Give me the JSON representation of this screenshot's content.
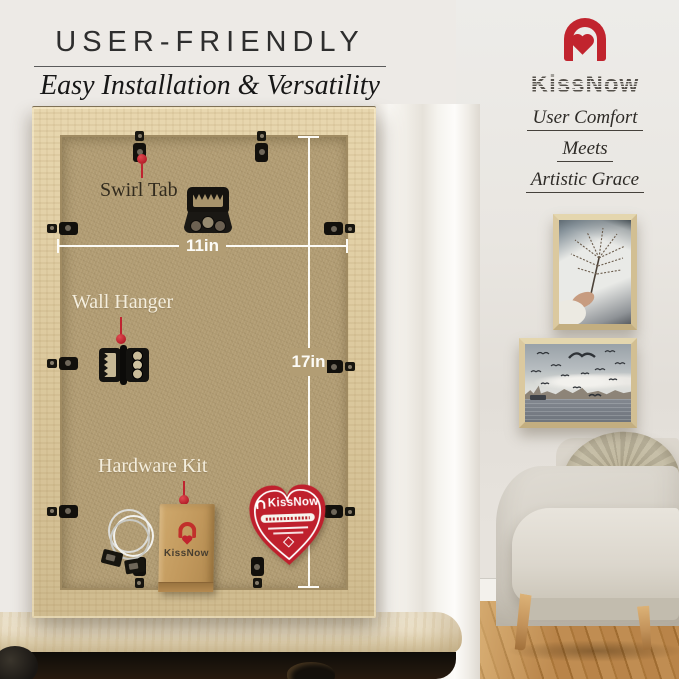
{
  "colors": {
    "accent_red": "#c1242e",
    "frame_wood": "#dcc9a0",
    "kraft_back": "#b29d74"
  },
  "header": {
    "title": "USER-FRIENDLY",
    "subtitle": "Easy Installation & Versatility"
  },
  "brand": {
    "logotype": "KissNow",
    "tagline": [
      "User Comfort",
      "Meets",
      "Artistic Grace"
    ]
  },
  "frame_back": {
    "callouts": {
      "swirl_tab": "Swirl Tab",
      "wall_hanger": "Wall Hanger",
      "hardware_kit": "Hardware Kit"
    },
    "dimensions": {
      "width": "11in",
      "height": "17in"
    },
    "hardware_bag": {
      "logotype": "KissNow"
    },
    "badge": {
      "logotype": "KissNow"
    }
  }
}
